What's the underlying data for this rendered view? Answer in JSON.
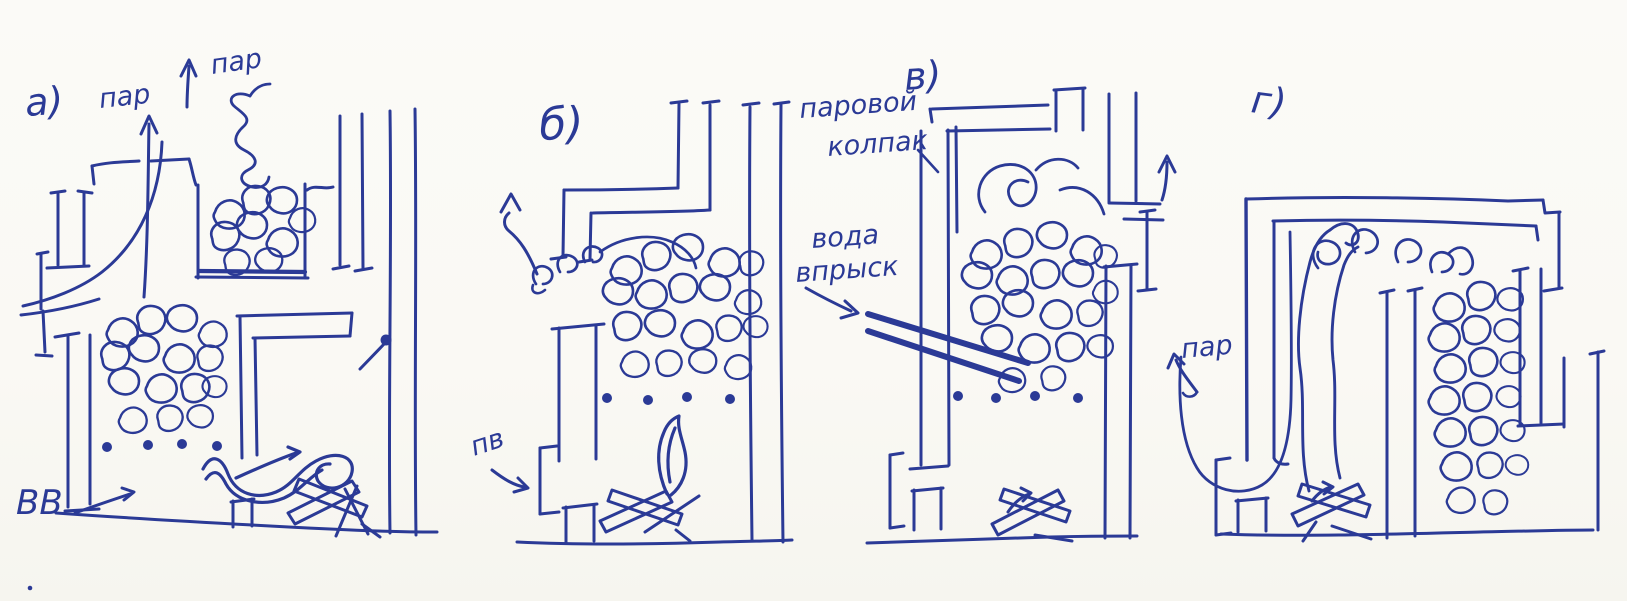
{
  "canvas": {
    "width": 1627,
    "height": 601,
    "paper_color": "#fbfaf6",
    "ink_color": "#2b3a96"
  },
  "panels": {
    "a": {
      "label": "а)",
      "steam_top_left": "пар",
      "steam_top_right": "пар",
      "air_inlet": "ВВ"
    },
    "b": {
      "label": "б)",
      "air_inlet": "пв"
    },
    "v": {
      "label": "в)",
      "hood_caption_line1": "паровой",
      "hood_caption_line2": "колпак",
      "water_caption_line1": "вода",
      "water_caption_line2": "впрыск"
    },
    "g": {
      "label": "г)",
      "steam_label": "пар"
    }
  }
}
